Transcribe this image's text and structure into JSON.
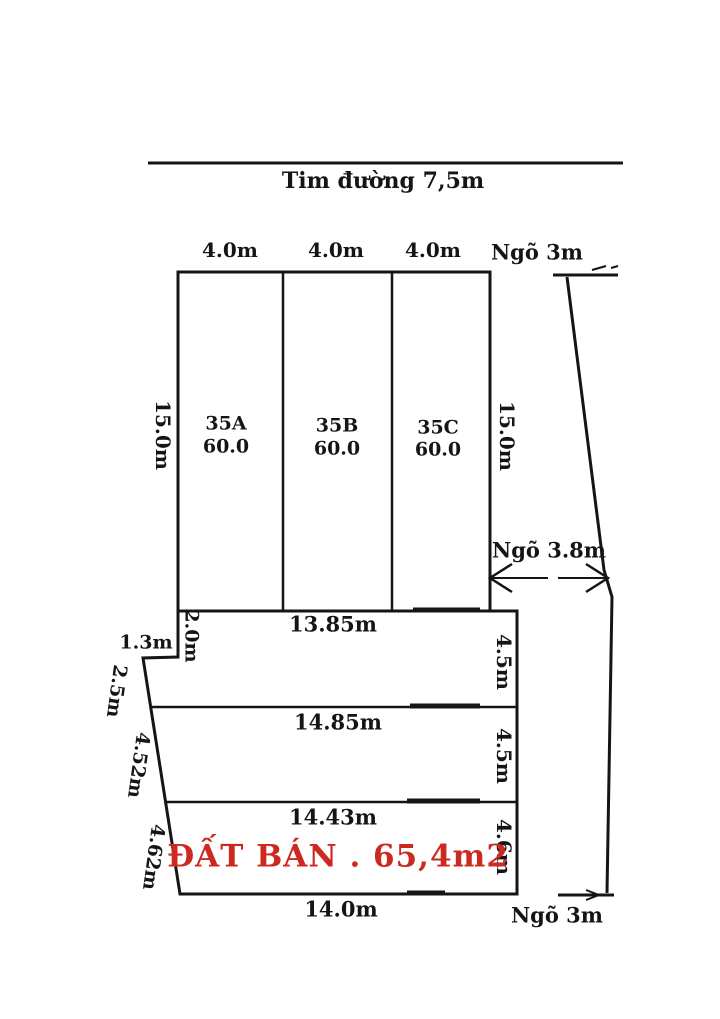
{
  "road": {
    "label": "Tim đường 7,5m"
  },
  "top_dims": [
    "4.0m",
    "4.0m",
    "4.0m"
  ],
  "alley": {
    "top": "Ngõ 3m",
    "mid": "Ngõ 3.8m",
    "bottom": "Ngõ 3m"
  },
  "plot_block": {
    "left_height": "15.0m",
    "right_height": "15.0m",
    "plots": [
      {
        "id": "35A",
        "area": "60.0"
      },
      {
        "id": "35B",
        "area": "60.0"
      },
      {
        "id": "35C",
        "area": "60.0"
      }
    ]
  },
  "lower": {
    "rows": [
      {
        "width": "13.85m",
        "height": "4.5m"
      },
      {
        "width": "14.85m",
        "height": "4.5m"
      },
      {
        "width": "14.43m",
        "height": "4.6m"
      }
    ],
    "bottom_width": "14.0m",
    "step_dims": {
      "vertical": "2.0m",
      "horizontal": "1.3m"
    },
    "slant_dims": [
      "2.5m",
      "4.52m",
      "4.62m"
    ],
    "sale": {
      "text": "ĐẤT BÁN . 65,4m2",
      "color": "#cc2a21"
    }
  },
  "colors": {
    "line": "#151515",
    "accent_red": "#cc2a21"
  }
}
